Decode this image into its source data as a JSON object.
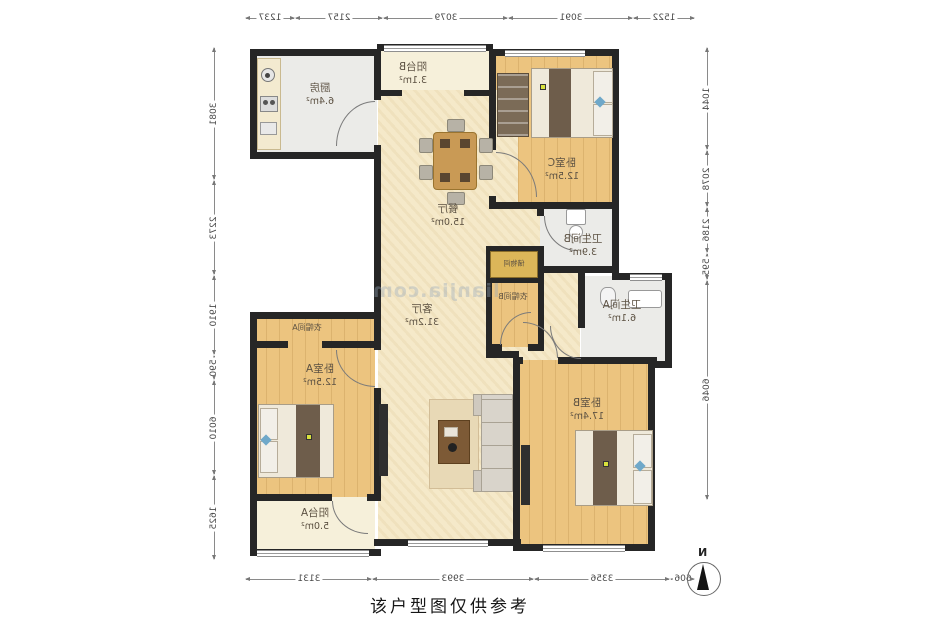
{
  "meta": {
    "caption": "该户型图仅供参考",
    "compass_label": "N",
    "watermark": "lianjia.com",
    "note": "floor plan image is horizontally mirrored; labels render reversed"
  },
  "colors": {
    "wall": "#262626",
    "wood_floor": "#ecc47f",
    "cream_floor": "#f5e9c9",
    "tile_floor": "#ebebe8",
    "dimension_text": "#4a4a4a",
    "label_text": "#5d5243",
    "accent_pillow": "#6fa8c9"
  },
  "rooms": {
    "kitchen": {
      "name": "厨房",
      "area": "6.4m²"
    },
    "balcony_b": {
      "name": "阳台B",
      "area": "3.1m²"
    },
    "bedroom_c": {
      "name": "卧室C",
      "area": "12.5m²"
    },
    "dining": {
      "name": "餐厅",
      "area": "15.0m²"
    },
    "bathroom_b": {
      "name": "卫生间B",
      "area": "3.9m²"
    },
    "storage": {
      "name": "储物间"
    },
    "closet_b": {
      "name": "衣帽间B"
    },
    "bathroom_a": {
      "name": "卫生间A",
      "area": "6.1m²"
    },
    "living": {
      "name": "客厅",
      "area": "31.2m²"
    },
    "closet_a": {
      "name": "衣帽间A"
    },
    "bedroom_a": {
      "name": "卧室A",
      "area": "12.5m²"
    },
    "balcony_a": {
      "name": "阳台A",
      "area": "5.0m²"
    },
    "bedroom_b": {
      "name": "卧室B",
      "area": "17.4m²"
    }
  },
  "dimensions_mm": {
    "top": [
      "1237",
      "2157",
      "3079",
      "3091",
      "1522"
    ],
    "bottom": [
      "3131",
      "3993",
      "3356",
      "606"
    ],
    "left": [
      "3081",
      "2273",
      "1910",
      "590",
      "6010",
      "1625"
    ],
    "right": [
      "1044",
      "2078",
      "2186",
      "595",
      "6046"
    ]
  }
}
